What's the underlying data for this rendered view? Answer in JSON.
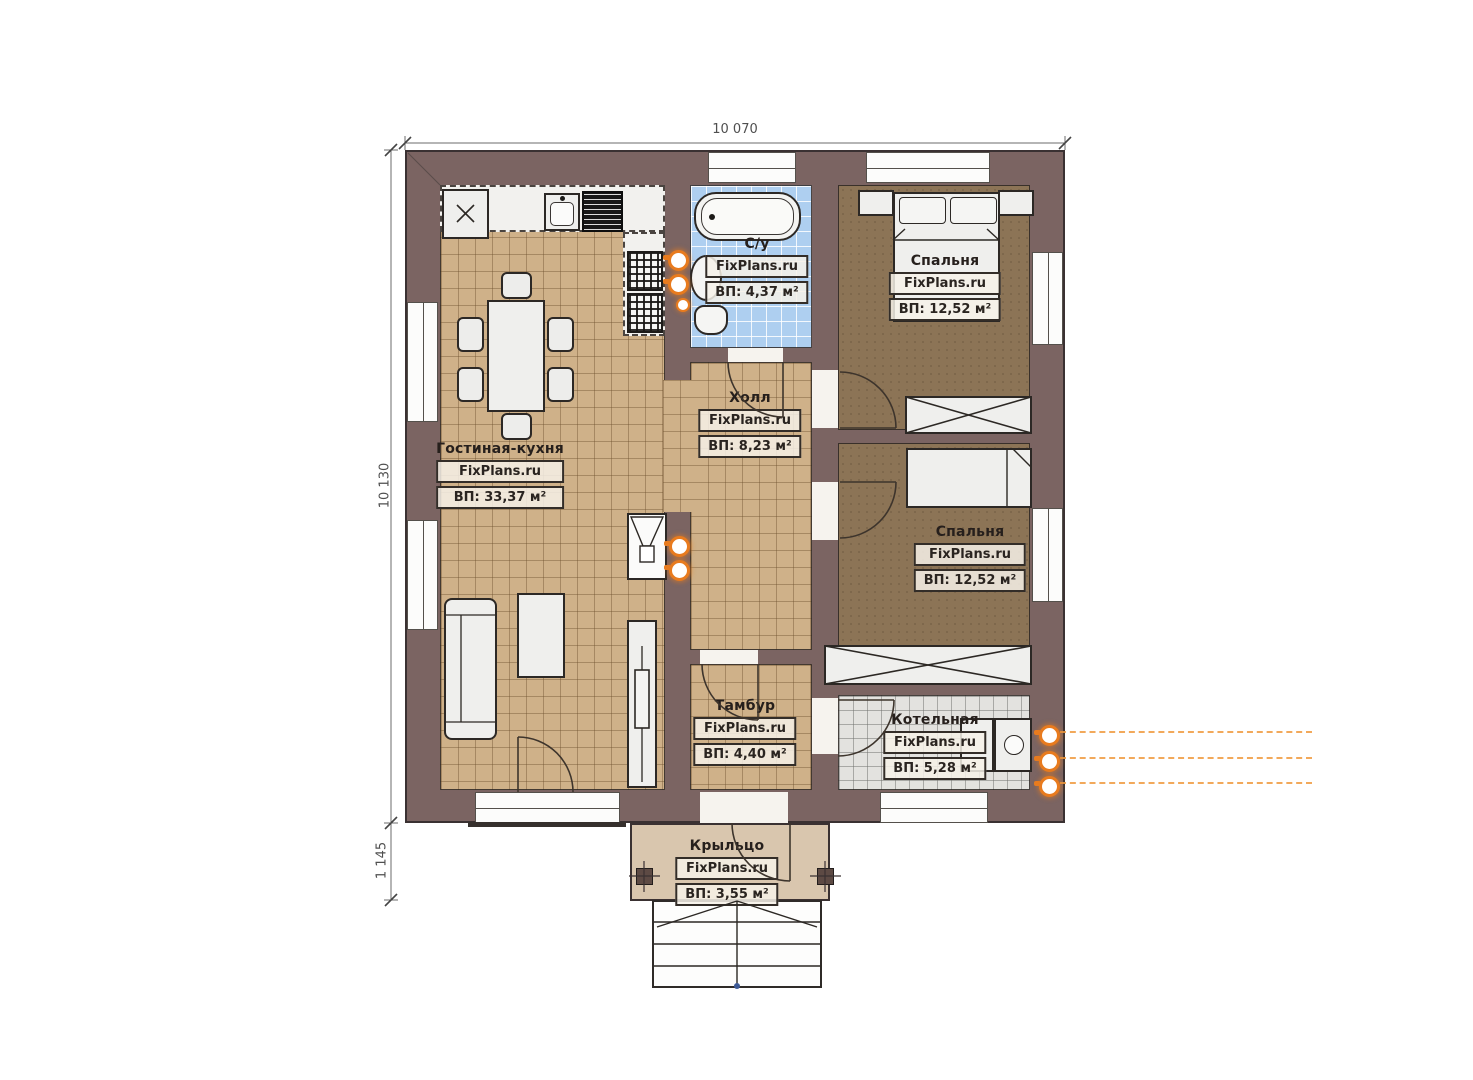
{
  "plan": {
    "brand": "FixPlans.ru",
    "dimensions": {
      "width_top": "10 070",
      "height_left": "10 130",
      "porch_height": "1 145"
    },
    "rooms": [
      {
        "name": "Гостиная-кухня",
        "brand": "FixPlans.ru",
        "area": "ВП: 33,37 м²"
      },
      {
        "name": "С/у",
        "brand": "FixPlans.ru",
        "area": "ВП: 4,37 м²"
      },
      {
        "name": "Холл",
        "brand": "FixPlans.ru",
        "area": "ВП: 8,23 м²"
      },
      {
        "name": "Спальня",
        "brand": "FixPlans.ru",
        "area": "ВП: 12,52 м²"
      },
      {
        "name": "Спальня",
        "brand": "FixPlans.ru",
        "area": "ВП: 12,52 м²"
      },
      {
        "name": "Тамбур",
        "brand": "FixPlans.ru",
        "area": "ВП: 4,40 м²"
      },
      {
        "name": "Котельная",
        "brand": "FixPlans.ru",
        "area": "ВП: 5,28 м²"
      },
      {
        "name": "Крыльцо",
        "brand": "FixPlans.ru",
        "area": "ВП: 3,55 м²"
      }
    ],
    "colors": {
      "wall": "#7b6462",
      "floor_tile_beige": "#cfb189",
      "floor_tile_blue": "#aecff0",
      "floor_bedroom": "#8c7456",
      "floor_boiler": "#e3e2df",
      "porch": "#d9c6ae",
      "utility_marker": "#e87b1e"
    }
  }
}
